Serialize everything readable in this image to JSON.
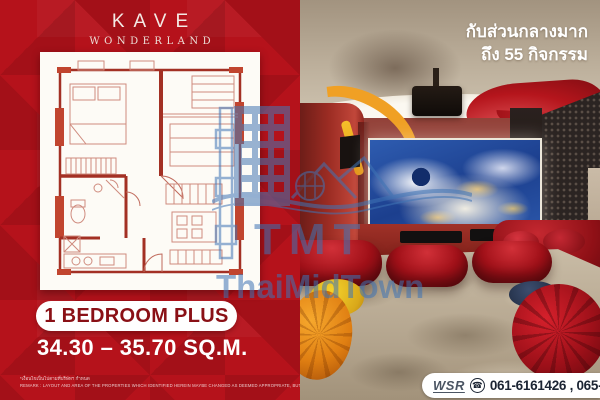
{
  "brand": {
    "name": "KAVE",
    "subname": "WONDERLAND"
  },
  "left_panel": {
    "unit_type": "1 BEDROOM PLUS",
    "area": "34.30 – 35.70 SQ.M.",
    "disclaimer_th": "*เงื่อนไขเป็นไปตามที่บริษัทฯ กำหนด",
    "disclaimer_en": "REMARK : LAYOUT AND AREA OF THE PROPERTIES WHICH IDENTIFIED HEREIN MAYBE CHANGED AS DEEMED APPROPRIATE, BUT WILL NOT IMPACT UPON THE USE.",
    "floor_plan_icon": "floor-plan-drawing"
  },
  "right_panel": {
    "headline_line1": "กับส่วนกลางมาก",
    "headline_line2": "ถึง 55 กิจกรรม",
    "scene": "home-theater-render",
    "contact": {
      "agent": "WSR",
      "phone_icon": "phone-icon",
      "numbers": "061-6161426 , 065-4496399"
    }
  },
  "watermark": {
    "abbr": "TMT",
    "name": "ThaiMidTown",
    "color": "#3f74b5"
  },
  "colors": {
    "left_bg": "#b5121b",
    "unit_text": "#8a1016",
    "plan_wall": "#a33024",
    "headline_text": "#ffffff",
    "phone_text": "#1b2433",
    "screen_blue": "#1c3f8e",
    "carpet": "#b4a58e",
    "bench_red": "#a01018"
  }
}
